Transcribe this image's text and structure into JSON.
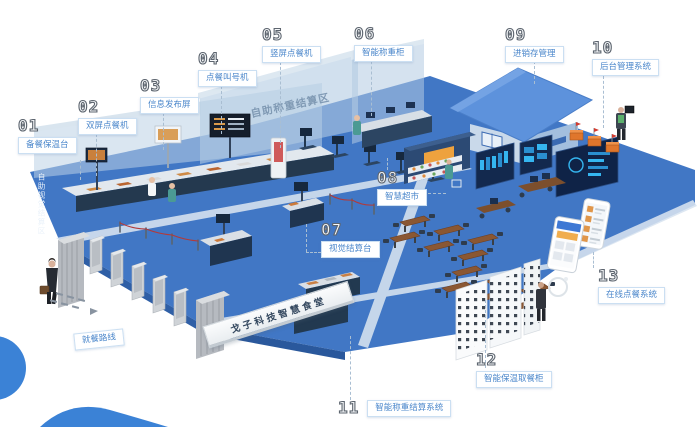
{
  "scene": {
    "banner": "戈子科技智慧食堂",
    "zones": {
      "visual_zone": "自助视觉结算区",
      "weighing_zone": "自助称重结算区",
      "dining_route": "就餐路线"
    },
    "callouts": [
      {
        "num": "01",
        "label": "备餐保温台"
      },
      {
        "num": "02",
        "label": "双屏点餐机"
      },
      {
        "num": "03",
        "label": "信息发布屏"
      },
      {
        "num": "04",
        "label": "点餐叫号机"
      },
      {
        "num": "05",
        "label": "竖屏点餐机"
      },
      {
        "num": "06",
        "label": "智能称重柜"
      },
      {
        "num": "07",
        "label": "视觉结算台"
      },
      {
        "num": "08",
        "label": "智慧超市"
      },
      {
        "num": "09",
        "label": "进销存管理"
      },
      {
        "num": "10",
        "label": "后台管理系统"
      },
      {
        "num": "11",
        "label": "智能称重结算系统"
      },
      {
        "num": "12",
        "label": "智能保温取餐柜"
      },
      {
        "num": "13",
        "label": "在线点餐系统"
      }
    ],
    "colors": {
      "floor": "#4177c5",
      "accent_blue": "#3b82d6",
      "label_text": "#4b87cb",
      "dashboard": "#13294e",
      "market_sign": "#eea23e",
      "table_wood": "#8a5733",
      "robot_orange": "#e0762c"
    }
  }
}
